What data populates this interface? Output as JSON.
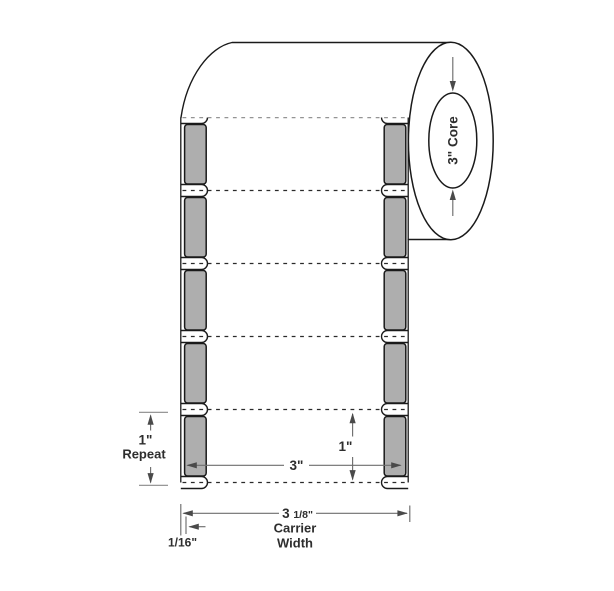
{
  "diagram": {
    "title": "Label roll specification diagram",
    "core": {
      "label": "3\" Core"
    },
    "dims": {
      "repeat_value": "1\"",
      "repeat_caption": "Repeat",
      "label_width": "3\"",
      "label_height": "1\"",
      "carrier_whole": "3 ",
      "carrier_fraction": "1/8\"",
      "carrier_caption_line1": "Carrier",
      "carrier_caption_line2": "Width",
      "edge_gap": "1/16\""
    },
    "colors": {
      "outline": "#1a1a1a",
      "dimension_line": "#6e6e6e",
      "tick_line": "#8a8a8a",
      "arrowhead": "#4a4a4a",
      "text": "#2e2e2e",
      "liner_gray": "#aeaeae",
      "background": "#ffffff"
    }
  }
}
